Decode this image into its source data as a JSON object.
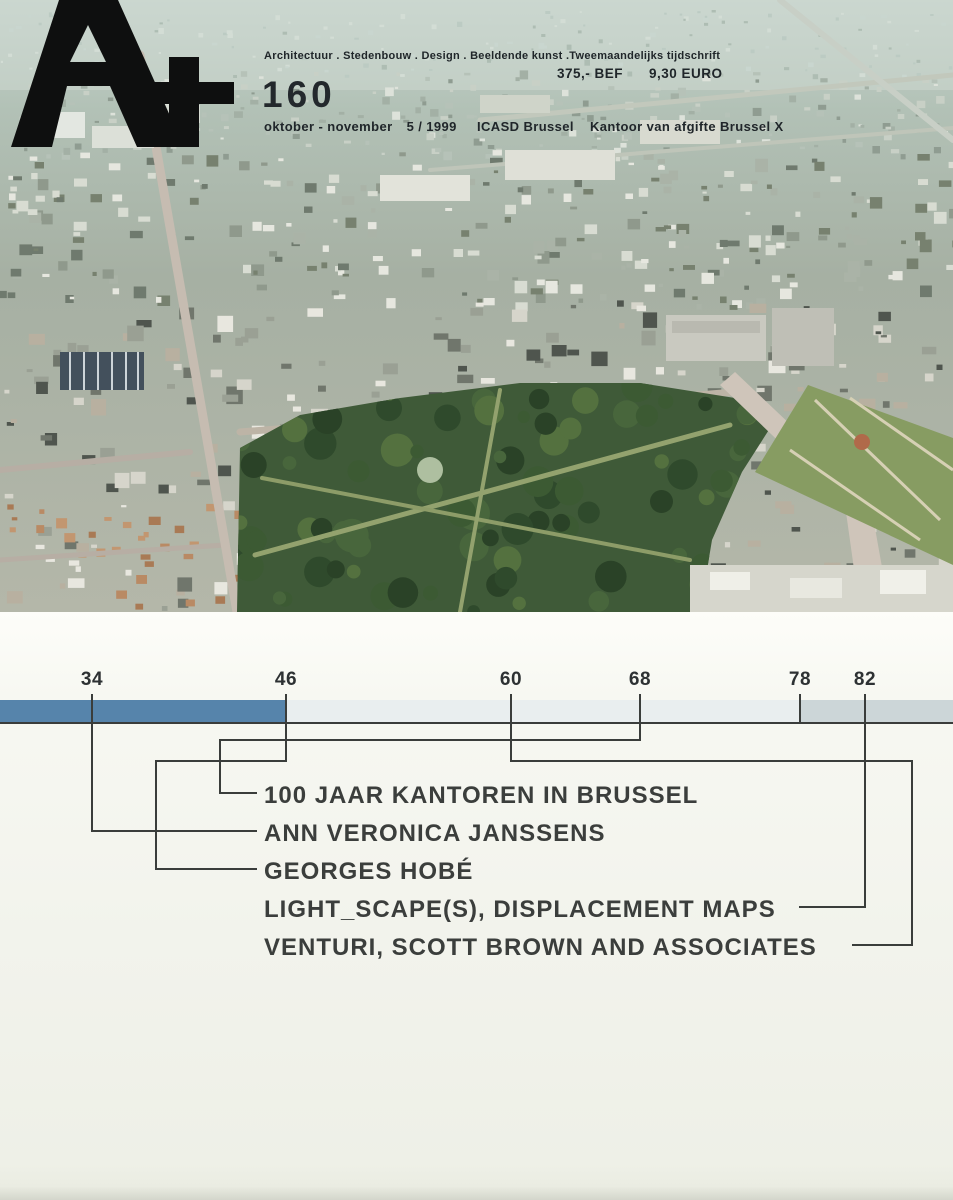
{
  "magazine": {
    "name": "A+",
    "issue": "160",
    "subtitle": "Architectuur . Stedenbouw . Design . Beeldende kunst .Tweemaandelijks tijdschrift",
    "price_bef": "375,- BEF",
    "price_euro": "9,30 EURO",
    "date_text": "oktober - november",
    "date_number": "5 / 1999",
    "postal_left": "ICASD Brussel",
    "postal_right": "Kantoor van afgifte Brussel X"
  },
  "photo": {
    "alt": "aerial photo of Brussels: city blocks, Warandepark and royal palace gardens"
  },
  "contents": {
    "page_numbers": [
      "34",
      "46",
      "60",
      "68",
      "78",
      "82"
    ],
    "items": [
      {
        "page": "68",
        "title": "100 JAAR KANTOREN IN BRUSSEL"
      },
      {
        "page": "34",
        "title": "ANN VERONICA JANSSENS"
      },
      {
        "page": "46",
        "title": "GEORGES HOBÉ"
      },
      {
        "page": "82",
        "title": "LIGHT_SCAPE(S), DISPLACEMENT MAPS"
      },
      {
        "page": "60",
        "title": "VENTURI, SCOTT BROWN AND ASSOCIATES"
      }
    ],
    "colors": {
      "bar_blue": "#5684ab",
      "bar_light": "#e9eeef",
      "bar_gray": "#ccd6d8",
      "line": "#3a3d3b"
    }
  }
}
